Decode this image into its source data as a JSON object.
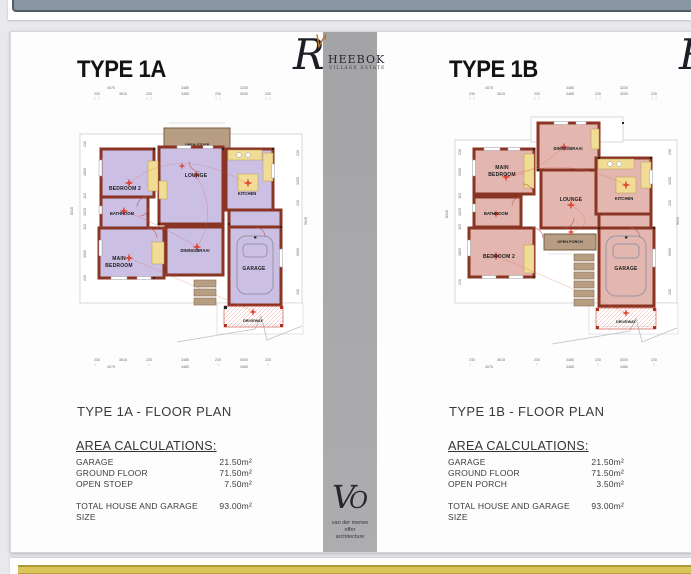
{
  "branding": {
    "logo_initial": "R",
    "logo_name_rest": "HEEBOK",
    "logo_subtitle": "VILLAGE ESTATE",
    "architect_monogram_v": "V",
    "architect_monogram_o": "O",
    "architect_line1": "van der merwe",
    "architect_line2": "offer",
    "architect_line3": "architecture"
  },
  "colors": {
    "wall": "#8a3524",
    "floor_type_1a": "#cbc0e4",
    "floor_type_1b": "#e3b7b0",
    "fixture_yellow": "#f1dc96",
    "porch_brown": "#b79d82",
    "symbol_red": "#e03a2a",
    "gold_frame": "#d9c45a",
    "divider_gray": "#a9a9ab"
  },
  "plan_a": {
    "title": "TYPE 1A",
    "caption": "TYPE 1A - FLOOR PLAN",
    "area_heading": "AREA CALCULATIONS:",
    "rows": [
      {
        "label": "GARAGE",
        "value": "21.50m²"
      },
      {
        "label": "GROUND FLOOR",
        "value": "71.50m²"
      },
      {
        "label": "OPEN STOEP",
        "value": "7.50m²"
      }
    ],
    "total_label": "TOTAL HOUSE AND GARAGE SIZE",
    "total_value": "93.00m²",
    "rooms": {
      "bedroom2": "BEDROOM 2",
      "bathroom": "BATHROOM",
      "main1": "MAIN",
      "main2": "BEDROOM",
      "lounge": "LOUNGE",
      "dining": "DINING/BRAAI",
      "kitchen": "KITCHEN",
      "garage": "GARAGE",
      "stoep": "OPEN STOEP",
      "driveway": "DRIVEWAY"
    },
    "dims": {
      "top1": [
        "4075",
        "3485",
        "3230"
      ],
      "top2": [
        "230",
        "3615",
        "230",
        "3485",
        "230",
        "3000",
        "230"
      ],
      "bottom1": [
        "230",
        "3615",
        "230",
        "3485",
        "230",
        "3000",
        "230"
      ],
      "bottom2": [
        "4075",
        "3485",
        "3480"
      ],
      "left": [
        "230",
        "2800",
        "115",
        "1625",
        "115",
        "3000",
        "230"
      ],
      "left_total": "8315",
      "right": [
        "230",
        "3255",
        "230",
        "6000",
        "230"
      ],
      "right_total": "9945"
    }
  },
  "plan_b": {
    "title": "TYPE 1B",
    "caption": "TYPE 1B - FLOOR PLAN",
    "area_heading": "AREA CALCULATIONS:",
    "rows": [
      {
        "label": "GARAGE",
        "value": "21.50m²"
      },
      {
        "label": "GROUND FLOOR",
        "value": "71.50m²"
      },
      {
        "label": "OPEN PORCH",
        "value": "3.50m²"
      }
    ],
    "total_label": "TOTAL HOUSE AND GARAGE SIZE",
    "total_value": "93.00m²",
    "rooms": {
      "main1": "MAIN",
      "main2": "BEDROOM",
      "dining": "DINING/BRAAI",
      "lounge": "LOUNGE",
      "kitchen": "KITCHEN",
      "bathroom": "BATHROOM",
      "bedroom2": "BEDROOM 2",
      "porch": "OPEN PORCH",
      "garage": "GARAGE",
      "driveway": "DRIVEWAY"
    },
    "dims": {
      "top1": [
        "4075",
        "3485",
        "3230"
      ],
      "top2": [
        "230",
        "3615",
        "230",
        "3485",
        "230",
        "3000",
        "230"
      ],
      "bottom1": [
        "230",
        "3615",
        "230",
        "3485",
        "230",
        "3000",
        "230"
      ],
      "bottom2": [
        "4075",
        "3485",
        "3480"
      ],
      "left": [
        "230",
        "3000",
        "115",
        "1625",
        "115",
        "2800",
        "230"
      ],
      "left_total": "8315",
      "right": [
        "230",
        "3255",
        "230",
        "6000",
        "230"
      ],
      "right_total": "9945"
    }
  }
}
